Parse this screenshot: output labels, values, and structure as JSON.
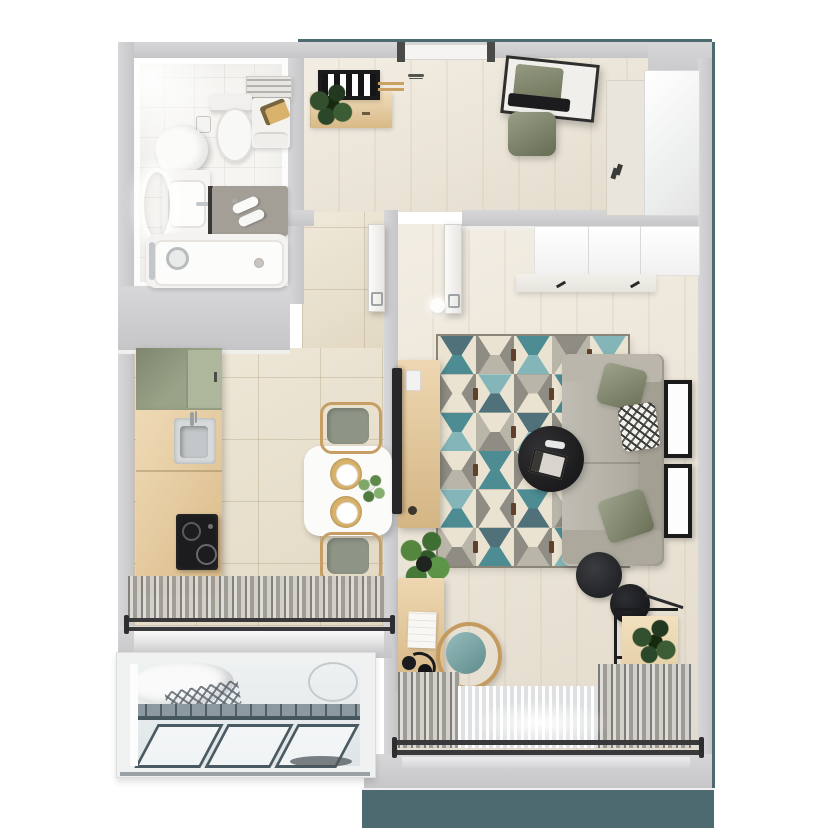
{
  "scene": {
    "type": "apartment-floorplan-top-down-render",
    "rooms": [
      "bathroom",
      "entry-hall",
      "kitchen-dining",
      "living-room",
      "balcony"
    ]
  },
  "palette": {
    "wall": "#c6c6c9",
    "wallLight": "#d7d7d9",
    "wallFace": "#f1efec",
    "facadeTeal": "#4d6a70",
    "woodFloor": "#ece4d4",
    "tileKitchen": "#e9dfc9",
    "bathTile": "#f6f5f2",
    "woodFurn": "#e6c58f",
    "woodFurnLight": "#edd4a4",
    "sage": "#9aa387",
    "sageLight": "#aeb79c",
    "olive": "#7c8465",
    "sofaGrey": "#b2aea3",
    "sofaGreyDark": "#a39f93",
    "chairTeal": "#72a5a5",
    "chairGrey": "#8e9486",
    "matGrey": "#a39e96",
    "black": "#1f1f21",
    "chrome": "#c3c7c9",
    "glass": "#e7edef",
    "metal": "#8c99a1",
    "rugBrown": "#5f402a",
    "gold": "#d9b36c"
  },
  "rug": {
    "x": 438,
    "y": 336,
    "w": 190,
    "h": 230,
    "cols": 5,
    "rows": 6,
    "colors": [
      "#eae3d1",
      "#4d8c93",
      "#84b6b9",
      "#8f8c83",
      "#50707a",
      "#b9b5a9",
      "#d9d2c0"
    ],
    "pattern": [
      [
        [
          0,
          4,
          1
        ],
        [
          3,
          0,
          5
        ],
        [
          0,
          1,
          2
        ],
        [
          5,
          3,
          0
        ],
        [
          0,
          2,
          1
        ]
      ],
      [
        [
          3,
          0,
          0
        ],
        [
          0,
          2,
          4
        ],
        [
          3,
          5,
          0
        ],
        [
          0,
          1,
          1
        ],
        [
          3,
          0,
          5
        ]
      ],
      [
        [
          0,
          1,
          2
        ],
        [
          5,
          0,
          3
        ],
        [
          0,
          4,
          2
        ],
        [
          3,
          0,
          0
        ],
        [
          0,
          1,
          4
        ]
      ],
      [
        [
          3,
          0,
          5
        ],
        [
          0,
          1,
          1
        ],
        [
          3,
          0,
          0
        ],
        [
          0,
          2,
          4
        ],
        [
          5,
          3,
          0
        ]
      ],
      [
        [
          0,
          2,
          1
        ],
        [
          3,
          0,
          0
        ],
        [
          0,
          1,
          4
        ],
        [
          5,
          0,
          3
        ],
        [
          0,
          4,
          2
        ]
      ],
      [
        [
          5,
          0,
          3
        ],
        [
          0,
          4,
          1
        ],
        [
          3,
          0,
          5
        ],
        [
          0,
          1,
          2
        ],
        [
          3,
          0,
          0
        ]
      ]
    ]
  }
}
